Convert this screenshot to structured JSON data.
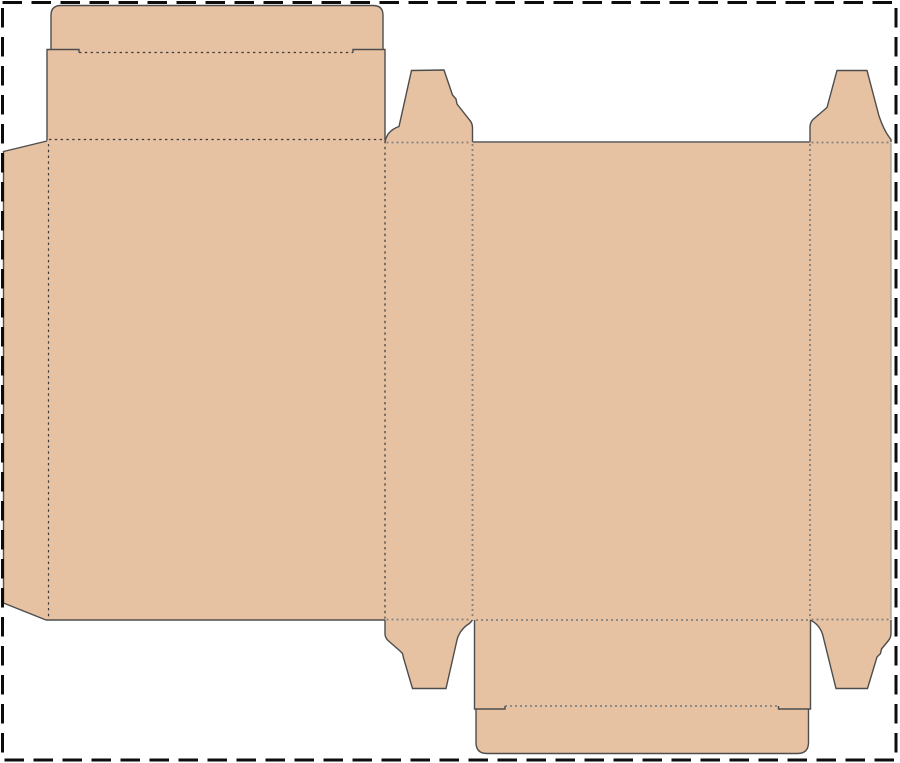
{
  "canvas": {
    "width": 900,
    "height": 763,
    "background": "#ffffff"
  },
  "colors": {
    "board_fill": "#e6c2a2",
    "cut_line": "#4d4d4d",
    "cut_line_gray": "#6e6e6e",
    "cut_line_light": "#9a9a9a",
    "fold_line_dark": "#3b3b3b",
    "fold_line_gray": "#828282",
    "sheet_border": "#0d0d0d",
    "background": "#ffffff"
  },
  "dieline": {
    "sheet_border": {
      "d": "M2.5,2.5 L896,2.5 L896,760 L2.5,760 Z",
      "dash_pattern": "19.5 9.5"
    },
    "panels": {
      "glue_flap": "M47,141 L3.5,151.5 L3.5,603 L46,620 L49.5,620 L49.5,141 Z",
      "front_panel": "M47,139.5 L385,139.5 L385,620 L47,620 Z",
      "lid_panel": "M47,49.5 L385,49.5 L385,140.5 L47,140.5 Z",
      "top_tuck_flap": "M51,51 L51,15 Q51,5.5 61,5.5 L373,5.5 Q383,5.5 383,15 L383,51 Z",
      "side_panel_left": "M385,142 L472.5,142 L472.5,620 L385,620 Z",
      "back_panel": "M472.5,142 L810,142 L810,620 L472.5,620 Z",
      "side_panel_right": "M810,142 L891,142 L891,620 L810,620 Z",
      "dust_flap_top_left": "M385,143 Q386.5,131 399,126.5 L411.5,70.5 L444,70 L452.5,95 L456,99 L457,104 L470,120.5 Q472.5,123.5 472.5,128 L472.5,143 Z",
      "dust_flap_top_right": "M810,143 L810,127.5 Q810,122.5 813,119.5 L827,107.5 L837,70.5 L867,70.5 L879,116 Q884,131 891,139.5 L891,143 Z",
      "dust_flap_bottom_left": "M385,619 L385,633.5 Q385,637.5 388,640.5 L399.5,650.5 L402.5,653.5 L403.5,658 L412.5,688.5 L446,688.5 L457,640 Q459.5,629.5 470,623 L472.5,619 Z",
      "dust_flap_bottom_right": "M810,619 Q819,624 822.5,634 L836,688.5 L867.5,688.5 L877,657 L880.5,653.5 L881.5,649 L888.5,640.5 Q891,637.5 891,633 L891,619 Z",
      "bottom_panel": "M474.5,620 L810.5,620 L810.5,709 L474.5,709 Z",
      "bottom_tuck_flap": "M476,708 L476,742.5 Q476,753.5 487,753.5 L797.5,753.5 Q808.5,753.5 808.5,742.5 L808.5,708 Z"
    },
    "cuts": {
      "glue_flap_outline": "M47,141 L3.5,151.5 L3.5,603 L46,620",
      "front_panel_bottom": "M46,620 L385,620",
      "lid_left_shoulder": "M47,140.5 L47,49.5 L79,49.5 L79,52.5",
      "lid_right_shoulder": "M385,140.5 L385,49.5 L353,49.5 L353,52.5",
      "top_tuck_outline": "M51,49.5 L51,15 Q51,5.5 61,5.5 L373,5.5 Q383,5.5 383,15 L383,49.5",
      "dust_top_left_outline": "M385,142.5 Q386.5,131 399,126.5 L411.5,70.5 L444,70 L452.5,95 L456,99 L457,104 L470,120.5 Q472.5,123.5 472.5,128 L472.5,142",
      "dust_top_right_outline": "M810,142 L810,127.5 Q810,122.5 813,119.5 L827,107.5 L837,70.5 L867,70.5 L879,116 Q884,131 891,139.5 L891,142",
      "dust_bottom_left_outline": "M385,620 L385,633.5 Q385,637.5 388,640.5 L399.5,650.5 L402.5,653.5 L403.5,658 L412.5,688.5 L446,688.5 L457,640 Q459.5,629.5 470,623 L472.5,620",
      "dust_bottom_right_outline": "M810,620 Q819,624 822.5,634 L836,688.5 L867.5,688.5 L877,657 L880.5,653.5 L881.5,649 L888.5,640.5 Q891,637.5 891,633 L891,620",
      "bottom_left_step": "M474.5,620 L474.5,709 L505,709 L505,706",
      "bottom_right_step": "M810.5,620 L810.5,709 L778.5,709 L778.5,706",
      "bottom_tuck_outline": "M476,709 L476,742.5 Q476,753.5 487,753.5 L797.5,753.5 Q808.5,753.5 808.5,742.5 L808.5,709",
      "back_panel_top": "M472.5,142 L810,142",
      "side_right_edge": "M891,143 L891,619"
    },
    "folds_dark": {
      "glue_fold": "M48.5,144 L48.5,617",
      "front_top_fold": "M49,139.5 L385,139.5",
      "top_tuck_fold": "M79,52.5 L353,52.5",
      "front_right_fold": "M385,141 L385,618.5"
    },
    "folds_gray": {
      "side_left_top_fold": "M386.5,142.5 L471,142.5",
      "side_left_right_fold": "M472.5,144 L472.5,618.5",
      "back_right_fold": "M810,144 L810,618.5",
      "side_right_top_fold": "M811.5,142.5 L889.5,142.5",
      "side_left_bottom_fold": "M386.5,619.5 L471,619.5",
      "back_bottom_fold": "M476,620 L809,620",
      "side_right_bottom_fold": "M811.5,619.5 L889.5,619.5",
      "bottom_tuck_fold": "M505,706 L778.5,706"
    }
  }
}
